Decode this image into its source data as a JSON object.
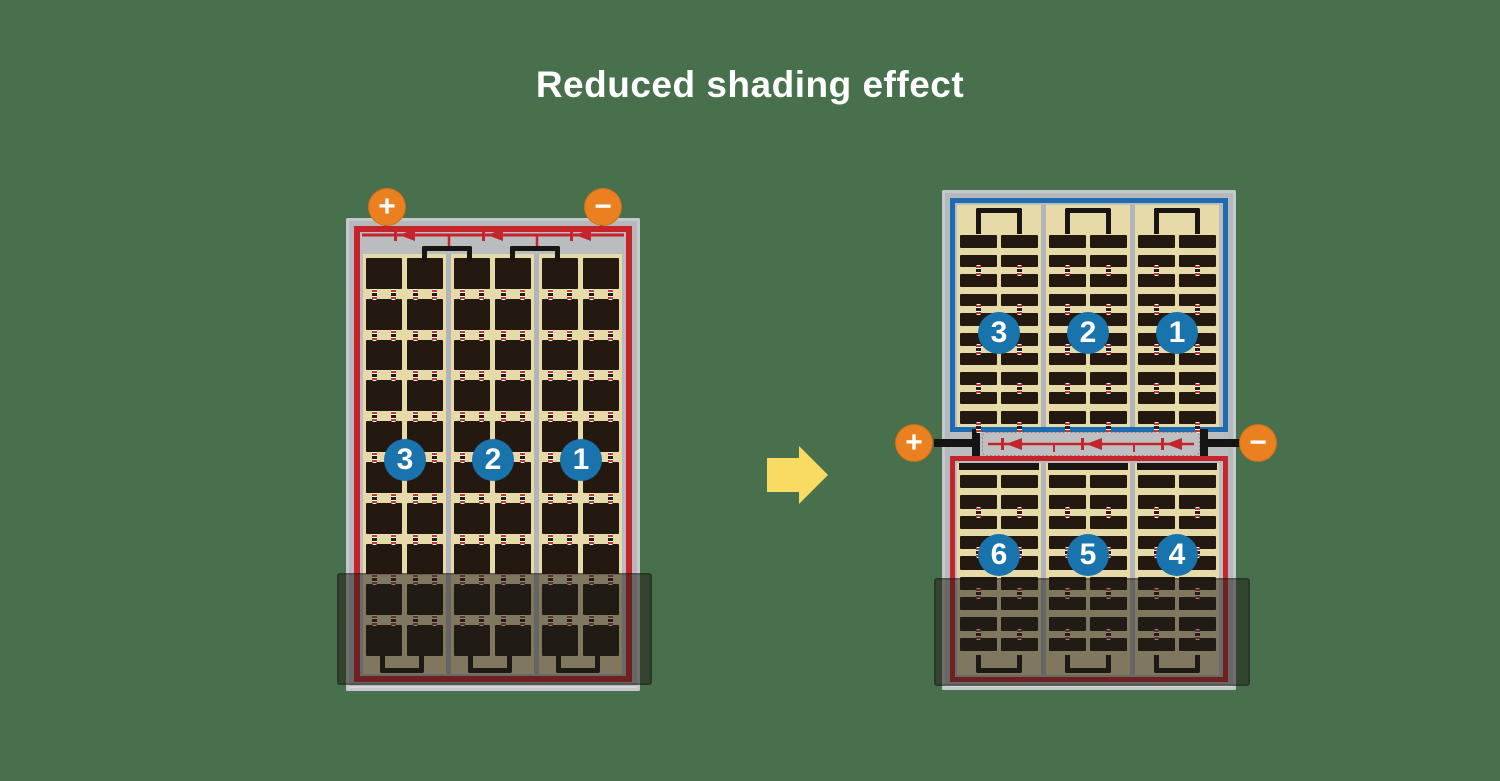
{
  "title": "Reduced shading effect",
  "colors": {
    "background": "#48704d",
    "title_text": "#ffffff",
    "panel_frame": "#b5b9bb",
    "red_outline": "#c5242b",
    "blue_outline": "#1d6cb1",
    "cell_dark": "#231911",
    "cell_field_tan": "#e6daa9",
    "terminal_orange": "#ea801f",
    "number_circle_blue": "#1973ac",
    "arrow_yellow": "#f9da62",
    "shade_overlay": "rgba(33,28,24,0.52)"
  },
  "before_panel": {
    "terminals": {
      "positive": "+",
      "negative": "−"
    },
    "section_numbers": [
      "3",
      "2",
      "1"
    ],
    "grid": {
      "rows": 10,
      "columns_per_section": 2
    },
    "diode_count": 3
  },
  "after_panel": {
    "terminals": {
      "positive": "+",
      "negative": "−"
    },
    "top_half": {
      "section_numbers": [
        "3",
        "2",
        "1"
      ],
      "grid": {
        "rows": 10,
        "columns_per_section": 2
      }
    },
    "bottom_half": {
      "section_numbers": [
        "6",
        "5",
        "4"
      ],
      "grid": {
        "rows": 9,
        "columns_per_section": 2
      }
    },
    "diode_count": 3
  }
}
